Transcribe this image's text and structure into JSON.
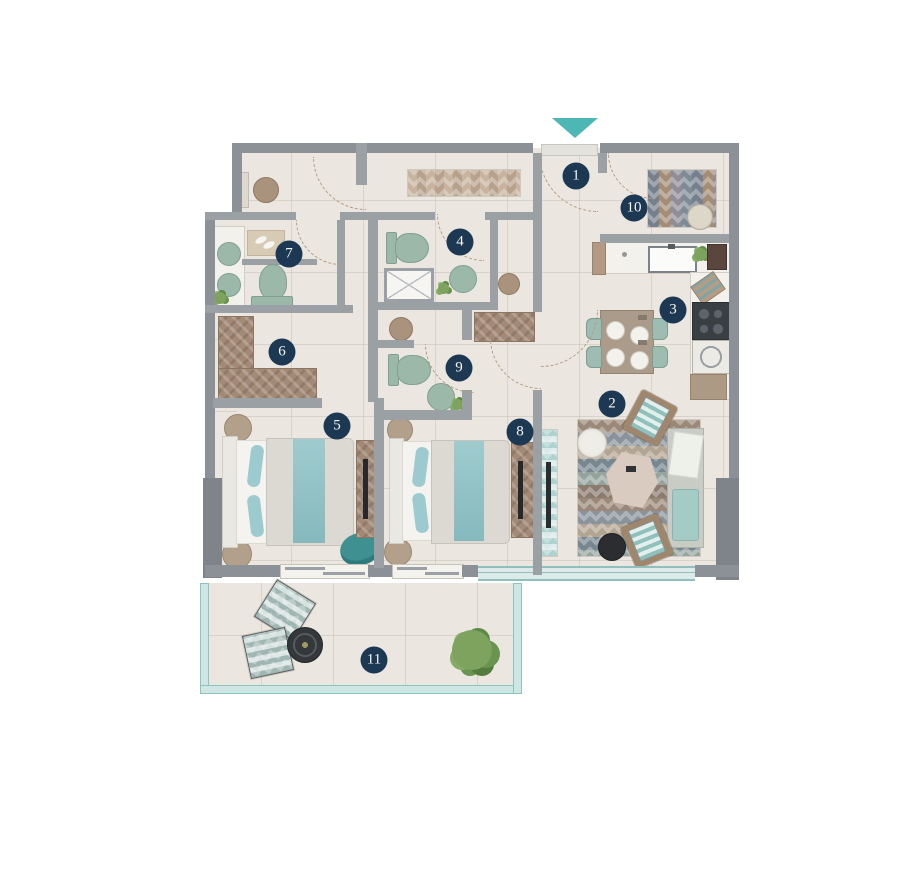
{
  "floor_plan": {
    "markers": [
      {
        "label": "1",
        "x": 576,
        "y": 176
      },
      {
        "label": "2",
        "x": 612,
        "y": 404
      },
      {
        "label": "3",
        "x": 673,
        "y": 310
      },
      {
        "label": "4",
        "x": 460,
        "y": 242
      },
      {
        "label": "5",
        "x": 337,
        "y": 426
      },
      {
        "label": "6",
        "x": 282,
        "y": 352
      },
      {
        "label": "7",
        "x": 289,
        "y": 254
      },
      {
        "label": "8",
        "x": 520,
        "y": 432
      },
      {
        "label": "9",
        "x": 459,
        "y": 368
      },
      {
        "label": "10",
        "x": 634,
        "y": 208
      },
      {
        "label": "11",
        "x": 374,
        "y": 660
      }
    ],
    "colors": {
      "badge": "#1d3852",
      "badge_text": "#f7f6f3",
      "entry_arrow": "#4cb7b5",
      "wall": "#8b9196",
      "floor": "#ebe7e0",
      "window": "#cfe7e4",
      "window_frame": "#8fc3c0",
      "wood": "#a28a76",
      "fixture_sage": "#9cb8a9"
    }
  }
}
